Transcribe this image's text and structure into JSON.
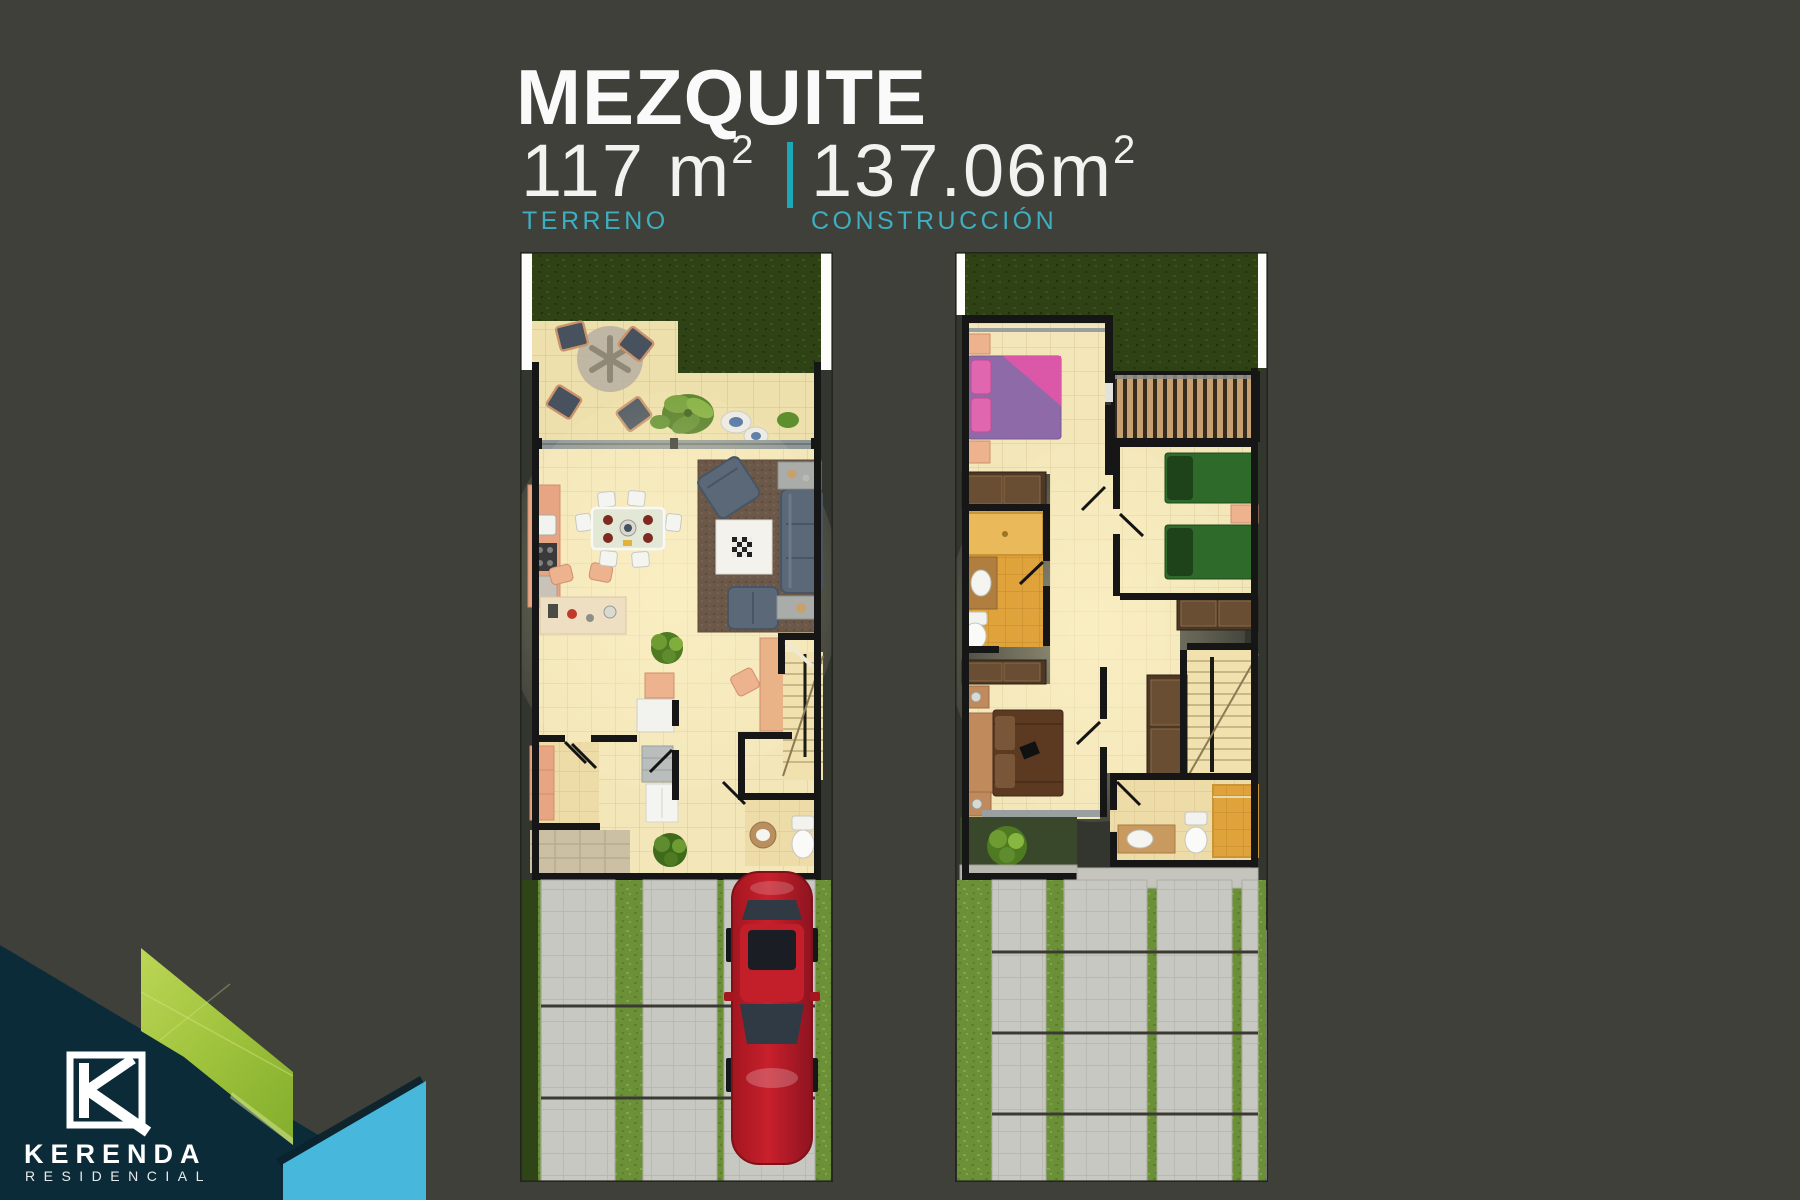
{
  "header": {
    "title": "MEZQUITE",
    "terrain": {
      "value": "117 m",
      "superscript": "2",
      "label": "TERRENO"
    },
    "construction": {
      "value": "137.06m",
      "superscript": "2",
      "label": "CONSTRUCCIÓN"
    }
  },
  "brand": {
    "name": "KERENDA",
    "tagline": "RESIDENCIAL"
  },
  "palette": {
    "background": "#3E4039",
    "title_white": "#FAFAFA",
    "accent_teal": "#1CA9B7",
    "label_teal": "#3FAEC0",
    "navy": "#0C2B39",
    "lime_green": "#A6C93F",
    "sky_blue": "#47B7DC"
  }
}
